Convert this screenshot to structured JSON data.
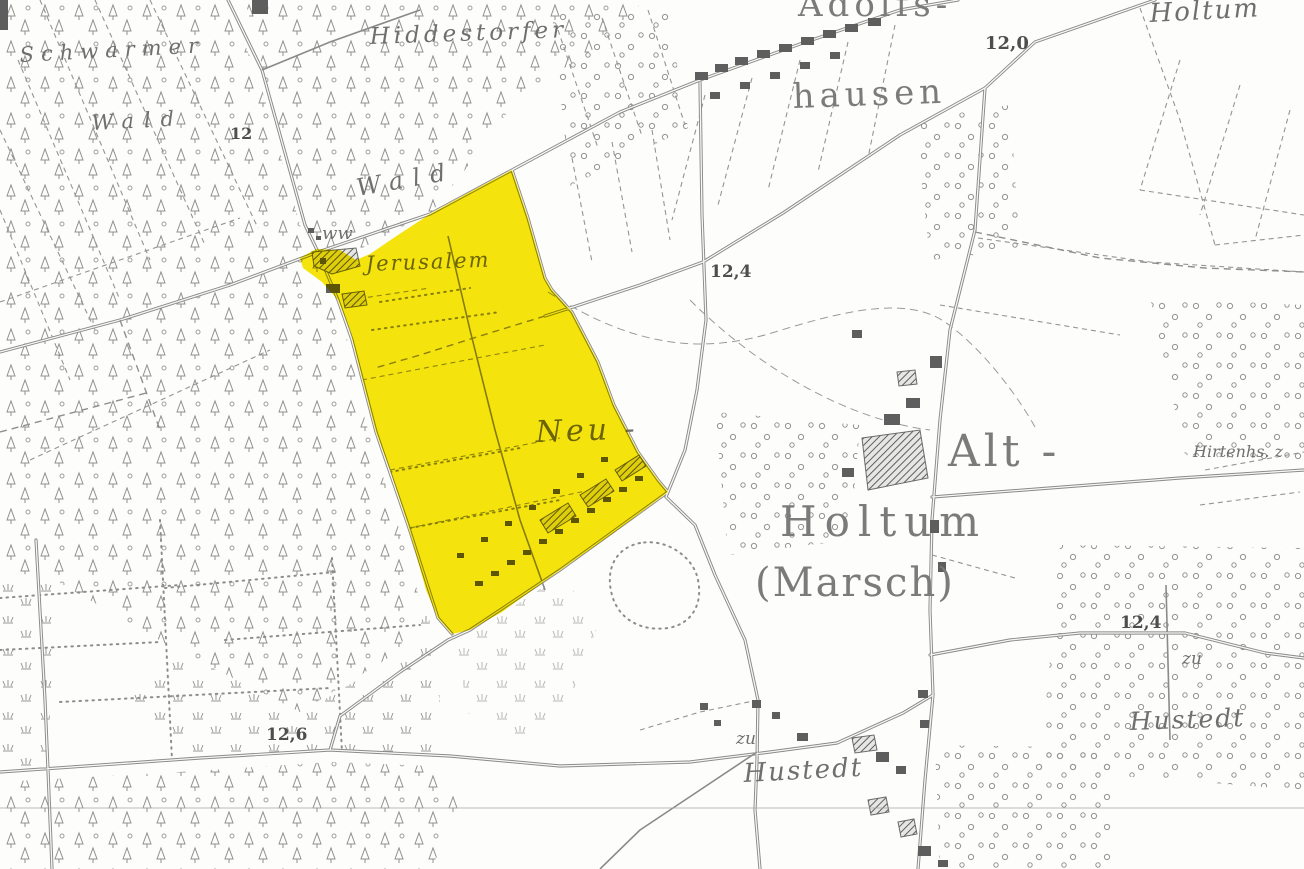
{
  "map": {
    "highlight_color": "#f6e400",
    "line_color": "#8a8a8a",
    "background_color": "#fdfdfb",
    "labels": {
      "schwarmer": "Schwarmer",
      "schwarmer_wald": "Wald",
      "parcel_number_12": "12",
      "hiddestorfer": "Hiddestorfer",
      "hiddestorfer_wald": "Wald",
      "ww": "ww",
      "jerusalem": "Jerusalem",
      "neu": "Neu -",
      "holtum": "Holtum",
      "marsch": "(Marsch)",
      "alt": "Alt -",
      "adolfshausen_top": "Adolfs-",
      "adolfshausen_bottom": "hausen",
      "holtum_northeast": "Holtum",
      "hirtenhaus": "Hirtenhs. z",
      "hustedt_west": "Hustedt",
      "hustedt_east": "Hustedt",
      "zu_west": "zu",
      "zu_east": "zu",
      "elevation_12_0": "12,0",
      "elevation_12_4_road": "12,4",
      "elevation_12_4_east": "12,4",
      "elevation_12_6": "12,6"
    }
  }
}
